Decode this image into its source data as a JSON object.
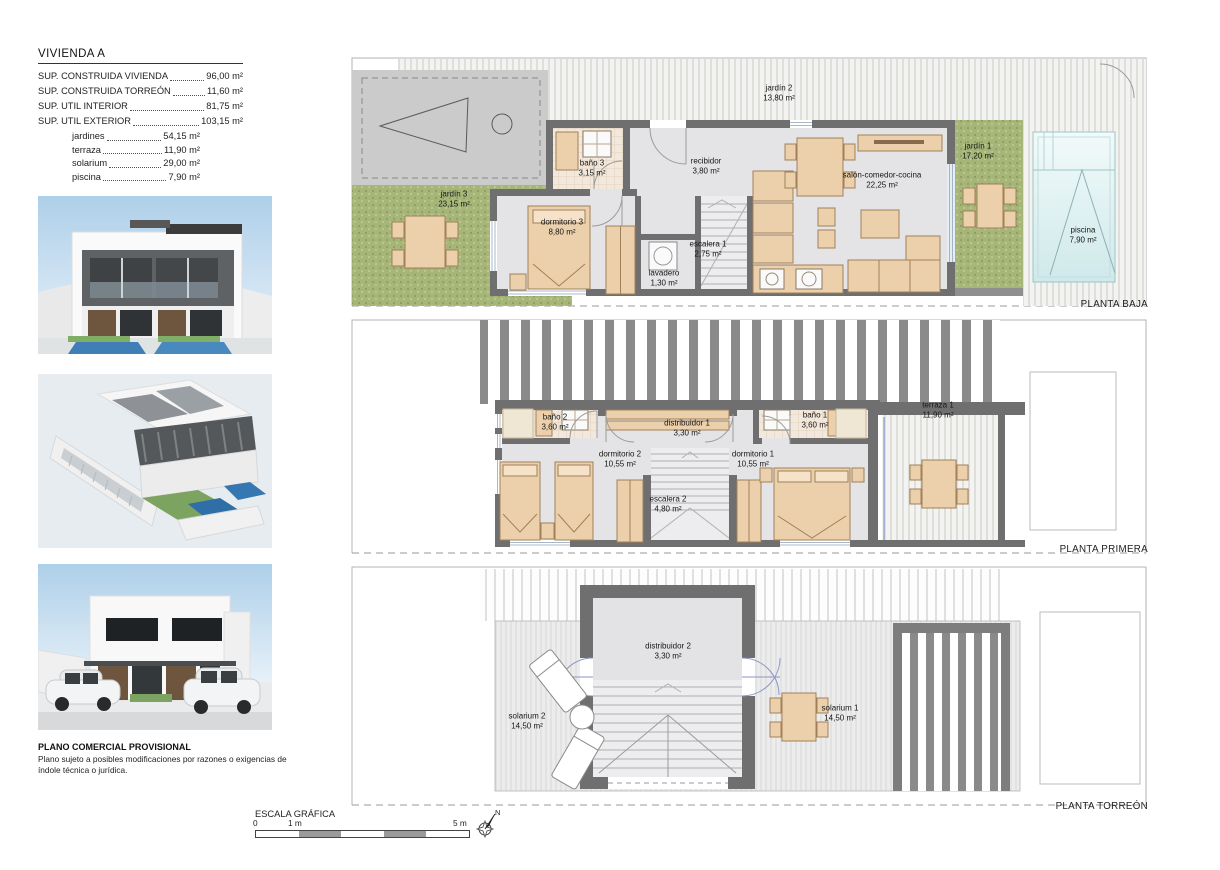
{
  "summary": {
    "title": "VIVIENDA A",
    "rows": [
      {
        "label": "SUP. CONSTRUIDA VIVIENDA",
        "value": "96,00 m²"
      },
      {
        "label": "SUP. CONSTRUIDA TORREÓN",
        "value": "11,60 m²"
      },
      {
        "label": "SUP. UTIL INTERIOR",
        "value": "81,75 m²"
      },
      {
        "label": "SUP. UTIL EXTERIOR",
        "value": "103,15 m²"
      }
    ],
    "subrows": [
      {
        "label": "jardines",
        "value": "54,15 m²"
      },
      {
        "label": "terraza",
        "value": "11,90 m²"
      },
      {
        "label": "solarium",
        "value": "29,00 m²"
      },
      {
        "label": "piscina",
        "value": "7,90 m²"
      }
    ]
  },
  "plans": {
    "baja": {
      "title": "PLANTA BAJA",
      "rooms": {
        "jardin2": {
          "name": "jardín 2",
          "area": "13,80 m²"
        },
        "jardin3": {
          "name": "jardín 3",
          "area": "23,15 m²"
        },
        "bano3": {
          "name": "baño 3",
          "area": "3,15 m²"
        },
        "recibidor": {
          "name": "recibidor",
          "area": "3,80 m²"
        },
        "dormitorio3": {
          "name": "dormitorio 3",
          "area": "8,80 m²"
        },
        "lavadero": {
          "name": "lavadero",
          "area": "1,30 m²"
        },
        "escalera1": {
          "name": "escalera 1",
          "area": "2,75 m²"
        },
        "salon": {
          "name": "salón-comedor-cocina",
          "area": "22,25 m²"
        },
        "jardin1": {
          "name": "jardín 1",
          "area": "17,20 m²"
        },
        "piscina": {
          "name": "piscina",
          "area": "7,90 m²"
        }
      }
    },
    "primera": {
      "title": "PLANTA PRIMERA",
      "rooms": {
        "bano2": {
          "name": "baño 2",
          "area": "3,60 m²"
        },
        "distribuidor1": {
          "name": "distribuidor 1",
          "area": "3,30 m²"
        },
        "bano1": {
          "name": "baño 1",
          "area": "3,60 m²"
        },
        "dormitorio2": {
          "name": "dormitorio 2",
          "area": "10,55 m²"
        },
        "dormitorio1": {
          "name": "dormitorio 1",
          "area": "10,55 m²"
        },
        "escalera2": {
          "name": "escalera 2",
          "area": "4,80 m²"
        },
        "terraza1": {
          "name": "terraza 1",
          "area": "11,90 m²"
        }
      }
    },
    "torreon": {
      "title": "PLANTA TORREÓN",
      "rooms": {
        "solarium2": {
          "name": "solarium 2",
          "area": "14,50 m²"
        },
        "distribuidor2": {
          "name": "distribuidor 2",
          "area": "3,30 m²"
        },
        "solarium1": {
          "name": "solarium 1",
          "area": "14,50 m²"
        }
      }
    }
  },
  "footer": {
    "title": "PLANO COMERCIAL PROVISIONAL",
    "line1": "Plano sujeto a posibles modificaciones por razones o exigencias de",
    "line2": "índole técnica o jurídica."
  },
  "scale_bar": {
    "title": "ESCALA GRÁFICA",
    "tick_zero": "0",
    "tick_one": "1 m",
    "tick_five": "5 m",
    "north_label": "N"
  }
}
